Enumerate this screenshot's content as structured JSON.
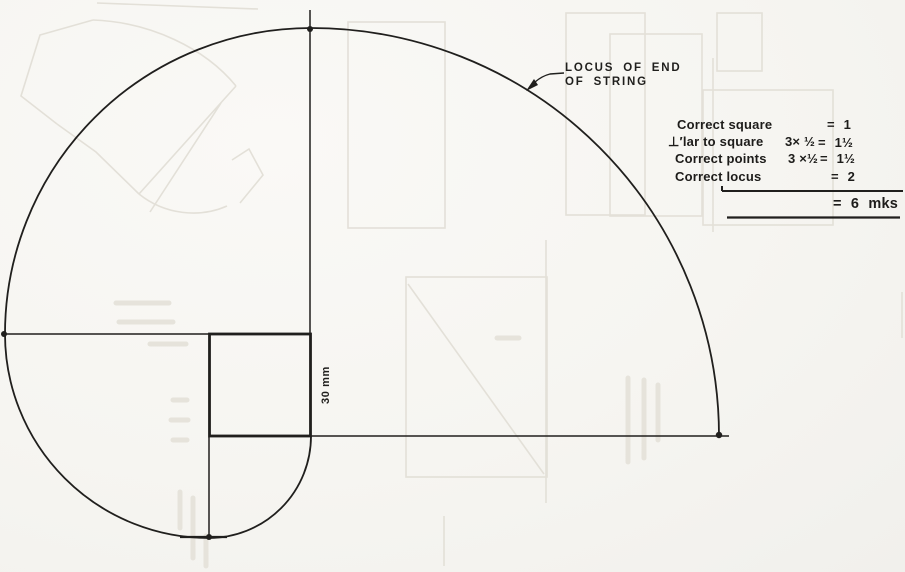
{
  "figure": {
    "curve_label_line1": "LOCUS OF END",
    "curve_label_line2": "OF STRING",
    "dimension_label": "30 mm"
  },
  "marking_scheme": {
    "rows": [
      {
        "item": "Correct square",
        "calc": "",
        "value": "= 1"
      },
      {
        "item": "⊥′lar to square",
        "calc": "3× ½",
        "value": "= 1½"
      },
      {
        "item": "Correct points",
        "calc": "3 ×½",
        "value": "= 1½"
      },
      {
        "item": "Correct locus",
        "calc": "",
        "value": "= 2"
      }
    ],
    "total": "= 6 mks"
  },
  "colors": {
    "ink": "#201f1d",
    "paper": "#f6f5f1",
    "ghost": "#e3e0d8"
  }
}
